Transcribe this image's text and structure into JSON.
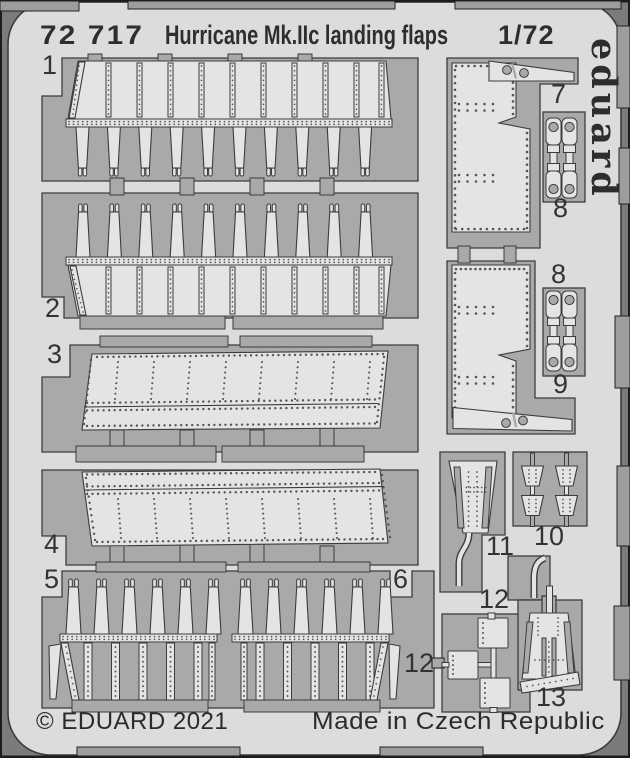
{
  "header": {
    "catalog_number": "72 717",
    "product_name": "Hurricane Mk.IIc landing flaps",
    "scale": "1/72"
  },
  "brand": {
    "logo": "eduard"
  },
  "footer": {
    "copyright": "© EDUARD 2021",
    "made_in": "Made in Czech Republic"
  },
  "part_labels": [
    {
      "text": "1"
    },
    {
      "text": "2"
    },
    {
      "text": "3"
    },
    {
      "text": "4"
    },
    {
      "text": "5"
    },
    {
      "text": "6"
    },
    {
      "text": "7"
    },
    {
      "text": "8"
    },
    {
      "text": "8"
    },
    {
      "text": "9"
    },
    {
      "text": "10"
    },
    {
      "text": "11"
    },
    {
      "text": "12"
    },
    {
      "text": "12"
    },
    {
      "text": "13"
    }
  ],
  "colors": {
    "mat": "#7b7b7b",
    "frame": "#1c1c1c",
    "sheet": "#dcdcdc",
    "window": "#a9a9a9",
    "tab": "#9d9d9d",
    "part": "#e4e4e4",
    "line": "#3c3c3c",
    "dot": "#565656",
    "text": "#2e2e2e"
  }
}
